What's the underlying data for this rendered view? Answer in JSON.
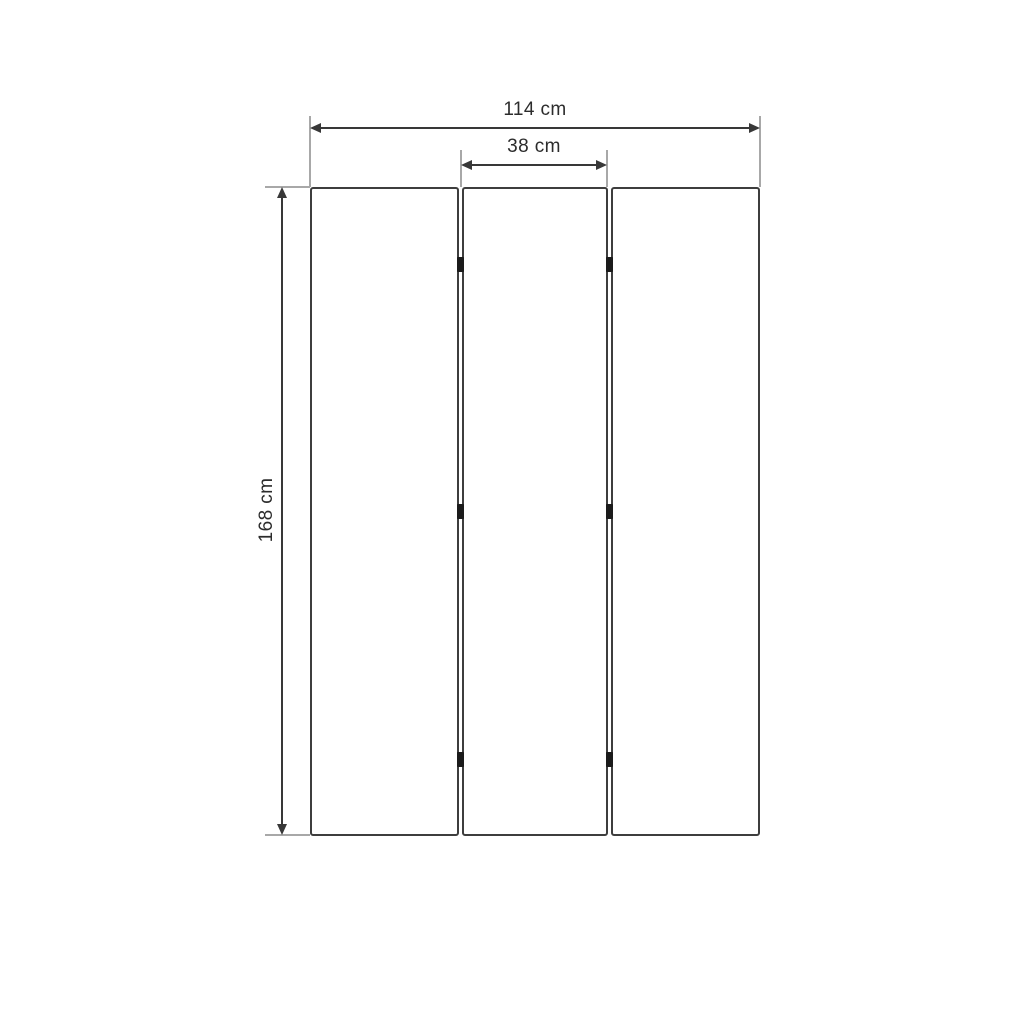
{
  "diagram": {
    "labels": {
      "total_width": "114 cm",
      "panel_width": "38 cm",
      "height": "168 cm"
    },
    "panel_count": 3,
    "hinge_count": 6,
    "colors": {
      "background": "#ffffff",
      "panel_border": "#3e3e3e",
      "dimension_line": "#383838",
      "extension_line": "#a8a8a8",
      "hinge": "#1b1b1b",
      "text": "#2c2c2c"
    }
  }
}
